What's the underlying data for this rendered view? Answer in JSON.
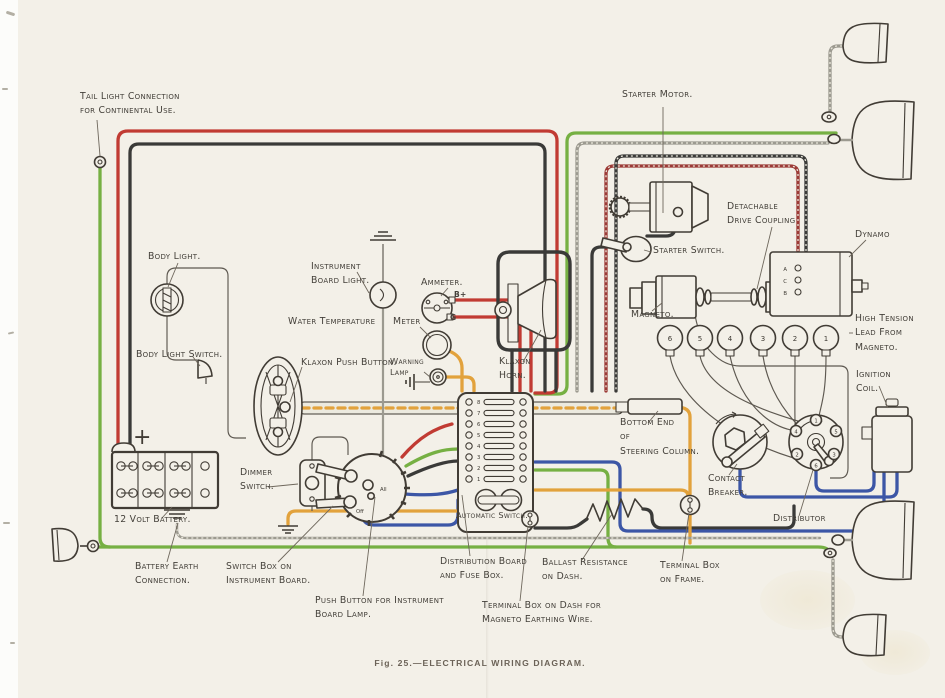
{
  "caption": "Fig. 25.—ELECTRICAL WIRING DIAGRAM.",
  "colors": {
    "paper": "#f3f0e8",
    "ink": "#413c35",
    "label_ink": "#44403a",
    "caption_ink": "#6b6257",
    "wire_red": "#c13b33",
    "wire_green": "#76b043",
    "wire_black": "#3a3a38",
    "wire_blue": "#3c56a6",
    "wire_orange": "#e2a23c",
    "wire_gray": "#9c9a90",
    "wire_darkred": "#9c3a36",
    "braid_light": "#e9e6da"
  },
  "labels": {
    "tail_light": "Tail Light Connection\nfor Continental Use.",
    "starter_motor": "Starter Motor.",
    "detachable_coupling": "Detachable\nDrive Coupling",
    "dynamo": "Dynamo",
    "body_light": "Body Light.",
    "instrument_light": "Instrument\nBoard Light.",
    "ammeter": "Ammeter.",
    "water_temperature": "Water Temperature",
    "meter": "Meter",
    "starter_switch": "Starter Switch.",
    "magneto": "Magneto.",
    "high_tension": "High Tension\nLead From\nMagneto.",
    "body_light_switch": "Body Light Switch.",
    "klaxon_push_button": "Klaxon Push Button.",
    "warning_lamp": "Warning\nLamp",
    "klaxon_horn": "Klaxon\nHorn.",
    "ignition_coil": "Ignition\nCoil.",
    "bottom_end": "Bottom End\nof\nSteering Column.",
    "contact_breaker": "Contact\nBreaker.",
    "dimmer_switch": "Dimmer\nSwitch.",
    "distributor": "Distributor",
    "battery": "12 Volt Battery.",
    "battery_earth": "Battery Earth\nConnection.",
    "switch_box": "Switch Box on\nInstrument Board.",
    "push_button": "Push Button for Instrument\nBoard Lamp.",
    "automatic_switch": "Automatic Switch.",
    "distribution_board": "Distribution Board\nand Fuse Box.",
    "ballast": "Ballast Resistance\non Dash.",
    "terminal_dash": "Terminal Box on Dash for\nMagneto Earthing Wire.",
    "terminal_frame": "Terminal Box\non Frame."
  },
  "components": {
    "ammeter": {
      "terminal_top": "B+",
      "terminal_bottom": "G"
    },
    "battery": {
      "plus": "+"
    },
    "dynamo": {
      "terminals": [
        "A",
        "C",
        "B"
      ]
    },
    "spark_plugs": {
      "numbers": [
        "6",
        "5",
        "4",
        "3",
        "2",
        "1"
      ]
    },
    "distributor": {
      "terminals": [
        "1",
        "5",
        "3",
        "6",
        "2",
        "4"
      ]
    },
    "fuse_box": {
      "numbers": [
        "8",
        "7",
        "6",
        "5",
        "4",
        "3",
        "2",
        "1"
      ]
    },
    "switch_box": {
      "marks": [
        "All",
        "Off"
      ]
    }
  }
}
